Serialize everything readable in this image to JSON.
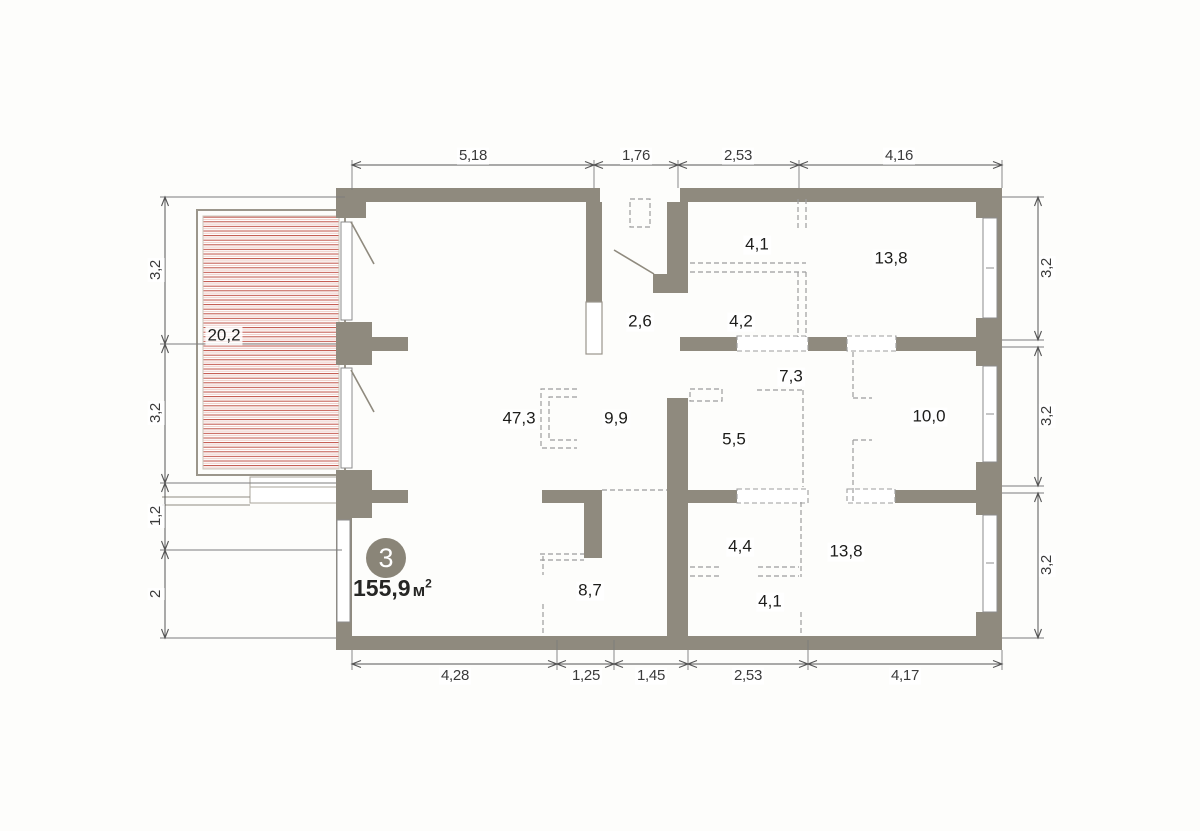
{
  "plan": {
    "badge": "3",
    "total_area": "155,9",
    "area_unit": "м",
    "area_unit_sup": "2",
    "rooms": {
      "balcony": "20,2",
      "hall": "2,6",
      "wardrobe_top": "4,1",
      "bath_top": "4,2",
      "bedroom_top_right": "13,8",
      "corridor": "7,3",
      "living": "47,3",
      "kitchen": "9,9",
      "bath_mid": "5,5",
      "bedroom_right": "10,0",
      "bath_bottom": "4,4",
      "bedroom_bottom_right": "13,8",
      "hall_bottom": "8,7",
      "wardrobe_bottom": "4,1"
    },
    "dims": {
      "top": [
        "5,18",
        "1,76",
        "2,53",
        "4,16"
      ],
      "bottom": [
        "4,28",
        "1,25",
        "1,45",
        "2,53",
        "4,17"
      ],
      "left": [
        "3,2",
        "3,2",
        "1,2",
        "2"
      ],
      "right": [
        "3,2",
        "3,2",
        "3,2"
      ]
    },
    "colors": {
      "wall": "#8F8A7E",
      "hatch_red": "#C05045",
      "dim_line": "#555555",
      "text": "#1D1D1B"
    }
  }
}
